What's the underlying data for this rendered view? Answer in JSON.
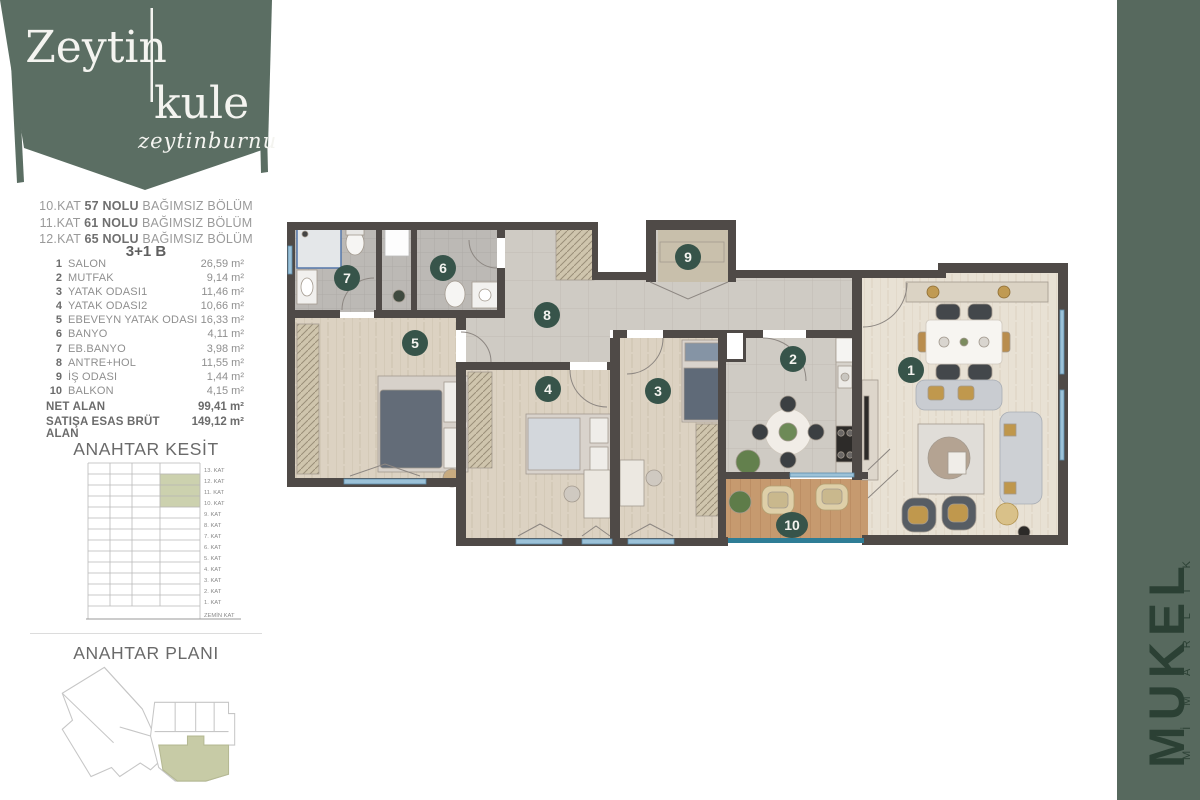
{
  "brand": {
    "line1": "Zeytin",
    "line2": "kule",
    "script": "zeytinburnu"
  },
  "unit": {
    "lines": [
      {
        "pre": "10.KAT",
        "bold": "57 NOLU",
        "rest": "BAĞIMSIZ BÖLÜM"
      },
      {
        "pre": "11.KAT",
        "bold": "61 NOLU",
        "rest": "BAĞIMSIZ BÖLÜM"
      },
      {
        "pre": "12.KAT",
        "bold": "65 NOLU",
        "rest": "BAĞIMSIZ BÖLÜM"
      }
    ],
    "type_label": "3+1 B"
  },
  "rooms": [
    {
      "no": "1",
      "name": "SALON",
      "area": "26,59 m²"
    },
    {
      "no": "2",
      "name": "MUTFAK",
      "area": "9,14 m²"
    },
    {
      "no": "3",
      "name": "YATAK ODASI1",
      "area": "11,46 m²"
    },
    {
      "no": "4",
      "name": "YATAK ODASI2",
      "area": "10,66 m²"
    },
    {
      "no": "5",
      "name": "EBEVEYN YATAK ODASI",
      "area": "16,33 m²"
    },
    {
      "no": "6",
      "name": "BANYO",
      "area": "4,11 m²"
    },
    {
      "no": "7",
      "name": "EB.BANYO",
      "area": "3,98 m²"
    },
    {
      "no": "8",
      "name": "ANTRE+HOL",
      "area": "11,55 m²"
    },
    {
      "no": "9",
      "name": "İŞ ODASI",
      "area": "1,44 m²"
    },
    {
      "no": "10",
      "name": "BALKON",
      "area": "4,15 m²"
    }
  ],
  "totals": [
    {
      "label": "NET ALAN",
      "value": "99,41 m²"
    },
    {
      "label": "SATIŞA ESAS BRÜT ALAN",
      "value": "149,12 m²"
    }
  ],
  "key_section": {
    "title": "ANAHTAR KESİT",
    "floors": [
      "13. KAT",
      "12. KAT",
      "11. KAT",
      "10. KAT",
      "9. KAT",
      "8. KAT",
      "7. KAT",
      "6. KAT",
      "5. KAT",
      "4. KAT",
      "3. KAT",
      "2. KAT",
      "1. KAT",
      "ZEMİN KAT"
    ],
    "highlighted_floors": [
      "12. KAT",
      "11. KAT",
      "10. KAT"
    ],
    "highlight_rows": [
      1,
      2,
      3
    ]
  },
  "key_plan": {
    "title": "ANAHTAR PLANI"
  },
  "plan": {
    "badges": [
      {
        "no": "1",
        "x": 911,
        "y": 370
      },
      {
        "no": "2",
        "x": 793,
        "y": 359
      },
      {
        "no": "3",
        "x": 658,
        "y": 391
      },
      {
        "no": "4",
        "x": 548,
        "y": 389
      },
      {
        "no": "5",
        "x": 415,
        "y": 343
      },
      {
        "no": "6",
        "x": 443,
        "y": 268
      },
      {
        "no": "7",
        "x": 347,
        "y": 278
      },
      {
        "no": "8",
        "x": 547,
        "y": 315
      },
      {
        "no": "9",
        "x": 688,
        "y": 257
      },
      {
        "no": "10",
        "x": 792,
        "y": 525
      }
    ]
  },
  "architect": {
    "name": "MUKEL",
    "subtitle": "MİMARLIK"
  },
  "colors": {
    "banner_green": "#5b6e63",
    "bar_green": "#57695e",
    "badge_green": "#37544a",
    "wall": "#4f4a47",
    "highlight_olive": "#ccd1ae",
    "window_blue": "#9cc2d8",
    "balcony_glass": "#2e7d96"
  }
}
